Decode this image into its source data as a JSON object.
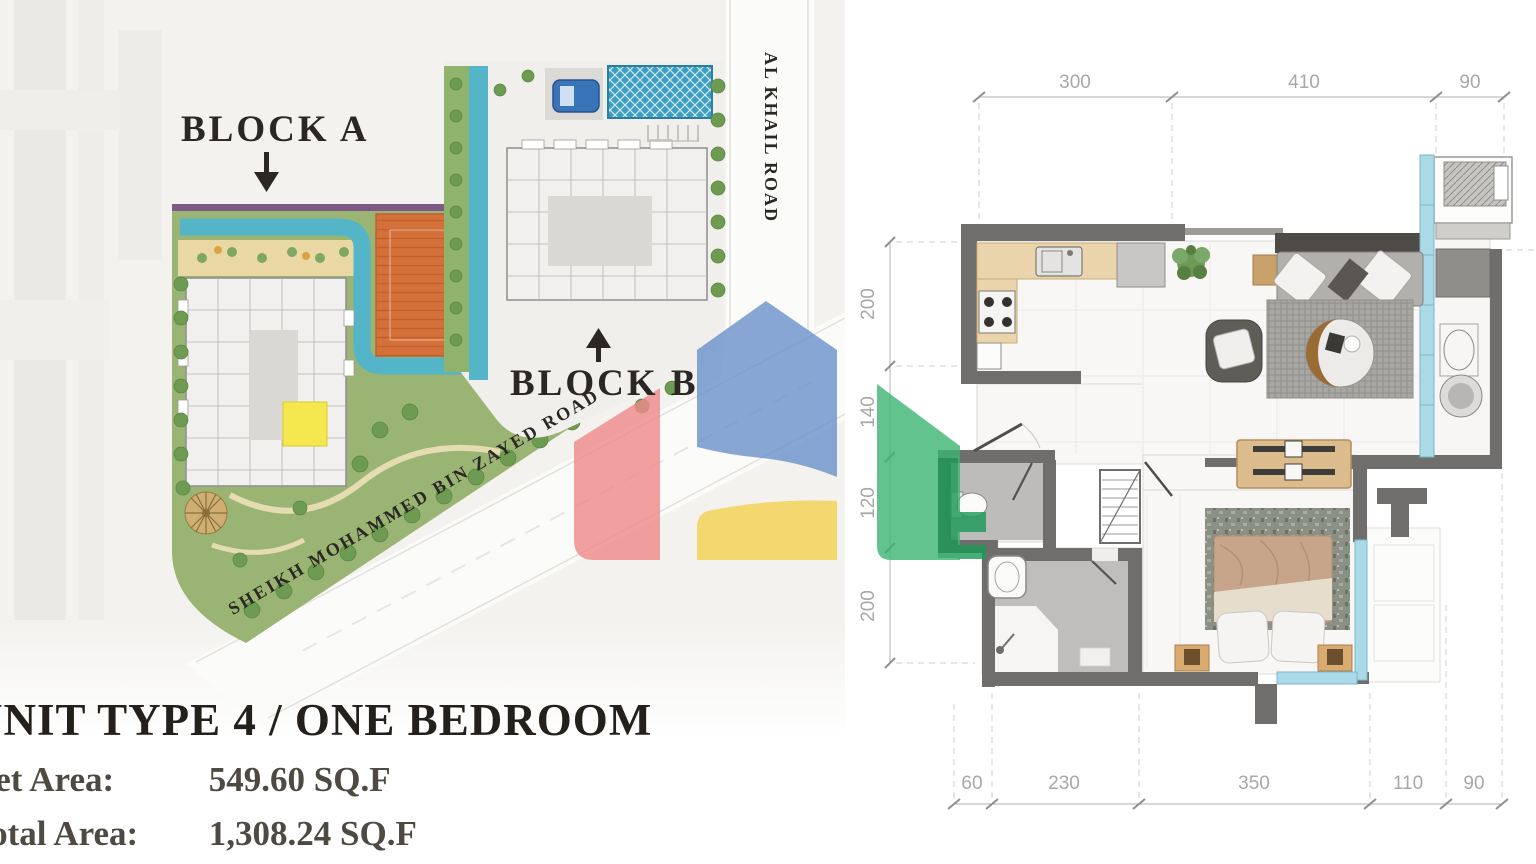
{
  "site_plan": {
    "block_a_label": "BLOCK A",
    "block_b_label": "BLOCK B",
    "al_khail_road_label": "AL KHAIL ROAD",
    "sheikh_road_label": "SHEIKH MOHAMMED BIN ZAYED ROAD"
  },
  "unit_info": {
    "title": "UNIT TYPE 4 / ONE BEDROOM",
    "net_area_label": "Net Area:",
    "net_area_value": "549.60 SQ.F",
    "total_area_label": "Total Area:",
    "total_area_value": "1,308.24 SQ.F"
  },
  "floor_plan": {
    "dimensions_top": [
      "300",
      "410",
      "90"
    ],
    "dimensions_left": [
      "200",
      "140",
      "120",
      "200"
    ],
    "dimensions_bottom": [
      "60",
      "230",
      "350",
      "110",
      "90"
    ]
  },
  "watermark": {
    "colors": {
      "red": "#f0898b",
      "blue": "#6b91cc",
      "yellow": "#f2d24f",
      "green": "#3cb573",
      "dark_green": "#1a9a58"
    }
  }
}
